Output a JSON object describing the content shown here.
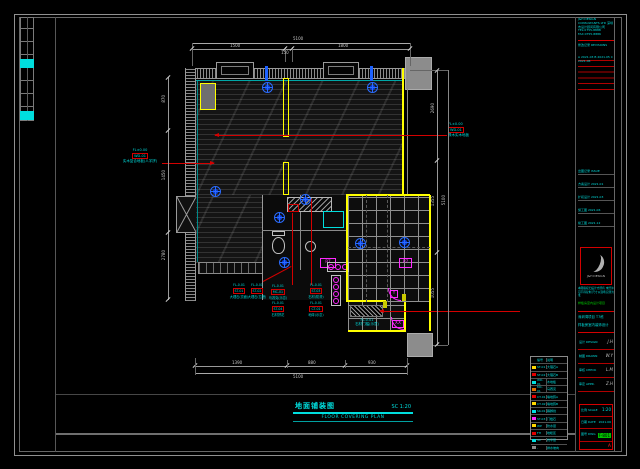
{
  "drawing": {
    "title_cn": "地面铺装图",
    "title_scale": "SC 1:20",
    "title_en": "FLOOR COVERING PLAN"
  },
  "dims": {
    "top_total": "5100",
    "top_segments": [
      "1500",
      "150",
      "1800"
    ],
    "bottom_segments": [
      "1390",
      "880",
      "930"
    ],
    "bottom_total": "5100",
    "right_segments": [
      "2690",
      "1355",
      "1055"
    ],
    "right_total": "5100",
    "left_segments": [
      "870",
      "1450",
      "2780"
    ]
  },
  "callouts": {
    "left": {
      "elev": "FL±0.00",
      "code": "WD-01",
      "desc": "实木复合地板(人字拼)"
    },
    "right": {
      "elev": "FL±0.00",
      "code": "WD-01",
      "desc": "橡木实木地板"
    },
    "threshold": {
      "elev": "FL-0.01",
      "desc": "石材门槛(示意)"
    },
    "cluster": [
      {
        "elev": "FL-0.01",
        "code": "ST-01",
        "desc": "大理石(亮面)"
      },
      {
        "elev": "FL-0.01",
        "code": "ST-02",
        "desc": "大理石(拉槽)"
      },
      {
        "elev": "FL-0.01",
        "code": "MC-01",
        "desc": "马赛克(示意)"
      },
      {
        "elev": "FL-0.01",
        "code": "ST-03",
        "desc": "石材(防滑)"
      },
      {
        "elev": "FL-0.01",
        "code": "ST-04",
        "desc": "石材拼花"
      },
      {
        "elev": "FL-0.01",
        "code": "CT-01",
        "desc": "地砖(示意)"
      }
    ]
  },
  "labels": {
    "p7a": "P7",
    "p7b": "P7",
    "door_y": "Y",
    "door_xx": "XX"
  },
  "legend": {
    "header": {
      "c1": "符",
      "c2": "编号",
      "c3": "说明"
    },
    "rows": [
      {
        "code": "ST-01",
        "name": "大理石A"
      },
      {
        "code": "ST-02",
        "name": "大理石B"
      },
      {
        "code": "WD-01",
        "name": "木地板"
      },
      {
        "code": "MC-01",
        "name": "马赛克"
      },
      {
        "code": "CT-01",
        "name": "墙地砖A"
      },
      {
        "code": "CT-02",
        "name": "墙地砖B"
      },
      {
        "code": "SK-01",
        "name": "踢脚线"
      },
      {
        "code": "ST-03",
        "name": "门槛石"
      },
      {
        "code": "WP",
        "name": "防水层"
      },
      {
        "code": "FH",
        "name": "地暖区"
      },
      {
        "code": "SC",
        "name": "找平层"
      },
      {
        "code": "-",
        "name": "排水坡向"
      }
    ]
  },
  "titleblock": {
    "company": "J&H DESIGN CONSULTANTS LTD 深圳市设计顾问有限公司 TEL:0755-8888 FAX:0755-8886",
    "rev_header": "修改记录 REVISIONS",
    "rev_rows": "A 2021.03  B 2021.05  C 2021.06",
    "issue_1": "出图记录 ISSUE",
    "issue_2": "方案设计 2021.01",
    "issue_3": "扩初设计 2021.03",
    "issue_4": "施工图 2021.06",
    "issue_5": "竣工图 2021.12",
    "logo_caption": "J&H DESIGN",
    "notes": "本图版权归设计方所有 未经许可不得复制 尺寸以现场实测为准",
    "stage_green": "样板房室内设计项目",
    "project_1": "深圳湾项目 T7栋",
    "project_2": "样板房室内装饰设计",
    "fields": [
      {
        "label": "设计 DESIGN",
        "value": "J.H"
      },
      {
        "label": "制图 DRAWN",
        "value": "W.Y"
      },
      {
        "label": "审核 CHECK",
        "value": "L.M"
      },
      {
        "label": "审定 APPR.",
        "value": "Z.H"
      }
    ],
    "scale_label": "比例 SCALE",
    "scale_value": "1:20",
    "date_label": "日期 DATE",
    "date_value": "2021.06",
    "dwg_label": "图号 DWG",
    "dwg_value": "F-801",
    "rev_value": "A"
  },
  "colors": {
    "cyan": "#00dede",
    "red": "#d40000",
    "magenta": "#ff2aff",
    "yellow": "#ffff00",
    "blue": "#2a6cff",
    "green": "#00d000"
  }
}
